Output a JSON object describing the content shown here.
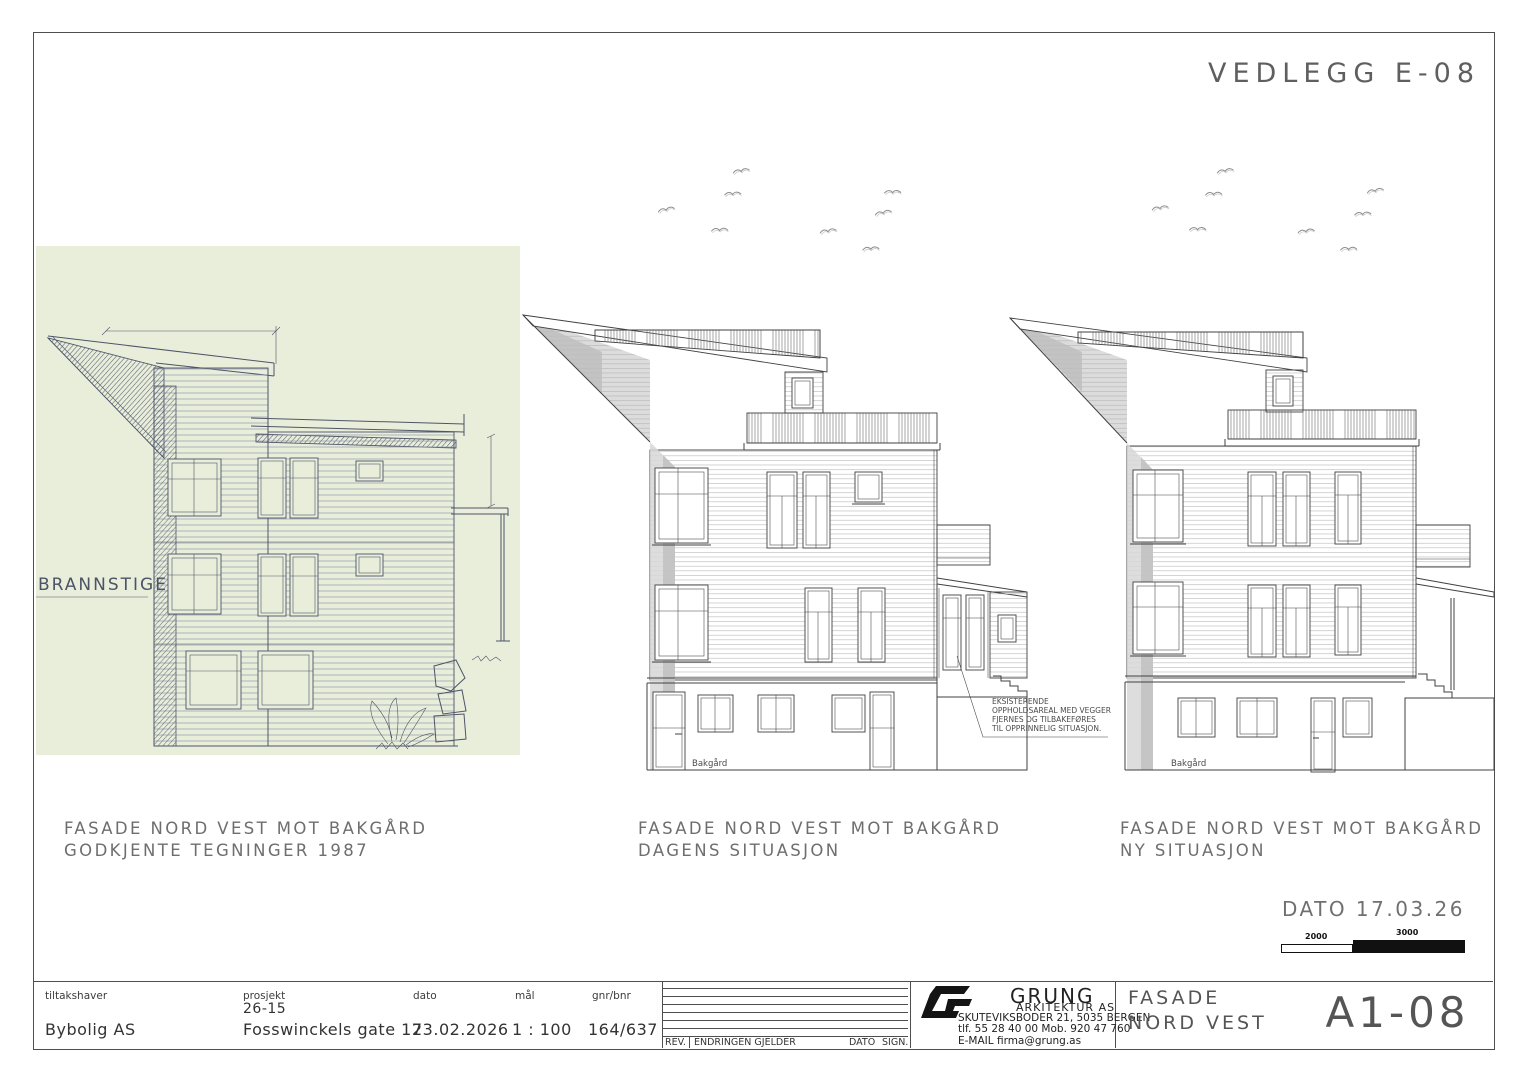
{
  "sheet": {
    "attachment_label": "VEDLEGG E-08",
    "date_note": "DATO 17.03.26",
    "scale_bar": {
      "segment1": "2000",
      "segment2": "3000"
    },
    "colors": {
      "scan_paper": "#e9eedb",
      "cad_line": "#414141",
      "shade_light": "#d7d7d7",
      "shade_dark": "#c2c2c2",
      "caption_gray": "#6e6e6e"
    }
  },
  "drawings": [
    {
      "caption_line1": "FASADE NORD VEST MOT BAKGÅRD",
      "caption_line2": "GODKJENTE TEGNINGER 1987",
      "label_brannstige": "BRANNSTIGE"
    },
    {
      "caption_line1": "FASADE NORD VEST MOT BAKGÅRD",
      "caption_line2": "DAGENS SITUASJON",
      "ground_label": "Bakgård",
      "annotation": [
        "EKSISTERENDE",
        "OPPHOLDSAREAL MED VEGGER",
        "FJERNES OG TILBAKEFØRES",
        "TIL OPPRINNELIG SITUASJON."
      ]
    },
    {
      "caption_line1": "FASADE NORD VEST MOT BAKGÅRD",
      "caption_line2": "NY SITUASJON",
      "ground_label": "Bakgård"
    }
  ],
  "title_block": {
    "tiltakshaver_label": "tiltakshaver",
    "tiltakshaver_value": "Bybolig AS",
    "prosjekt_label": "prosjekt",
    "prosjekt_number": "26-15",
    "prosjekt_value": "Fosswinckels gate 17",
    "dato_label": "dato",
    "dato_value": "23.02.2026",
    "maal_label": "mål",
    "maal_value": "1 : 100",
    "gnr_bnr_label": "gnr/bnr",
    "gnr_bnr_value": "164/637",
    "rev_label": "REV.",
    "endringen_label": "ENDRINGEN GJELDER",
    "rev_dato_label": "DATO",
    "sign_label": "SIGN.",
    "firm_name": "GRUNG",
    "firm_type": "ARKITEKTUR AS",
    "firm_address": "SKUTEVIKSBODER 21, 5035 BERGEN",
    "firm_phone": "tlf. 55 28 40 00 Mob. 920 47 760",
    "firm_email": "E-MAIL firma@grung.as",
    "sheet_title_line1": "FASADE",
    "sheet_title_line2": "NORD VEST",
    "sheet_number": "A1-08"
  }
}
